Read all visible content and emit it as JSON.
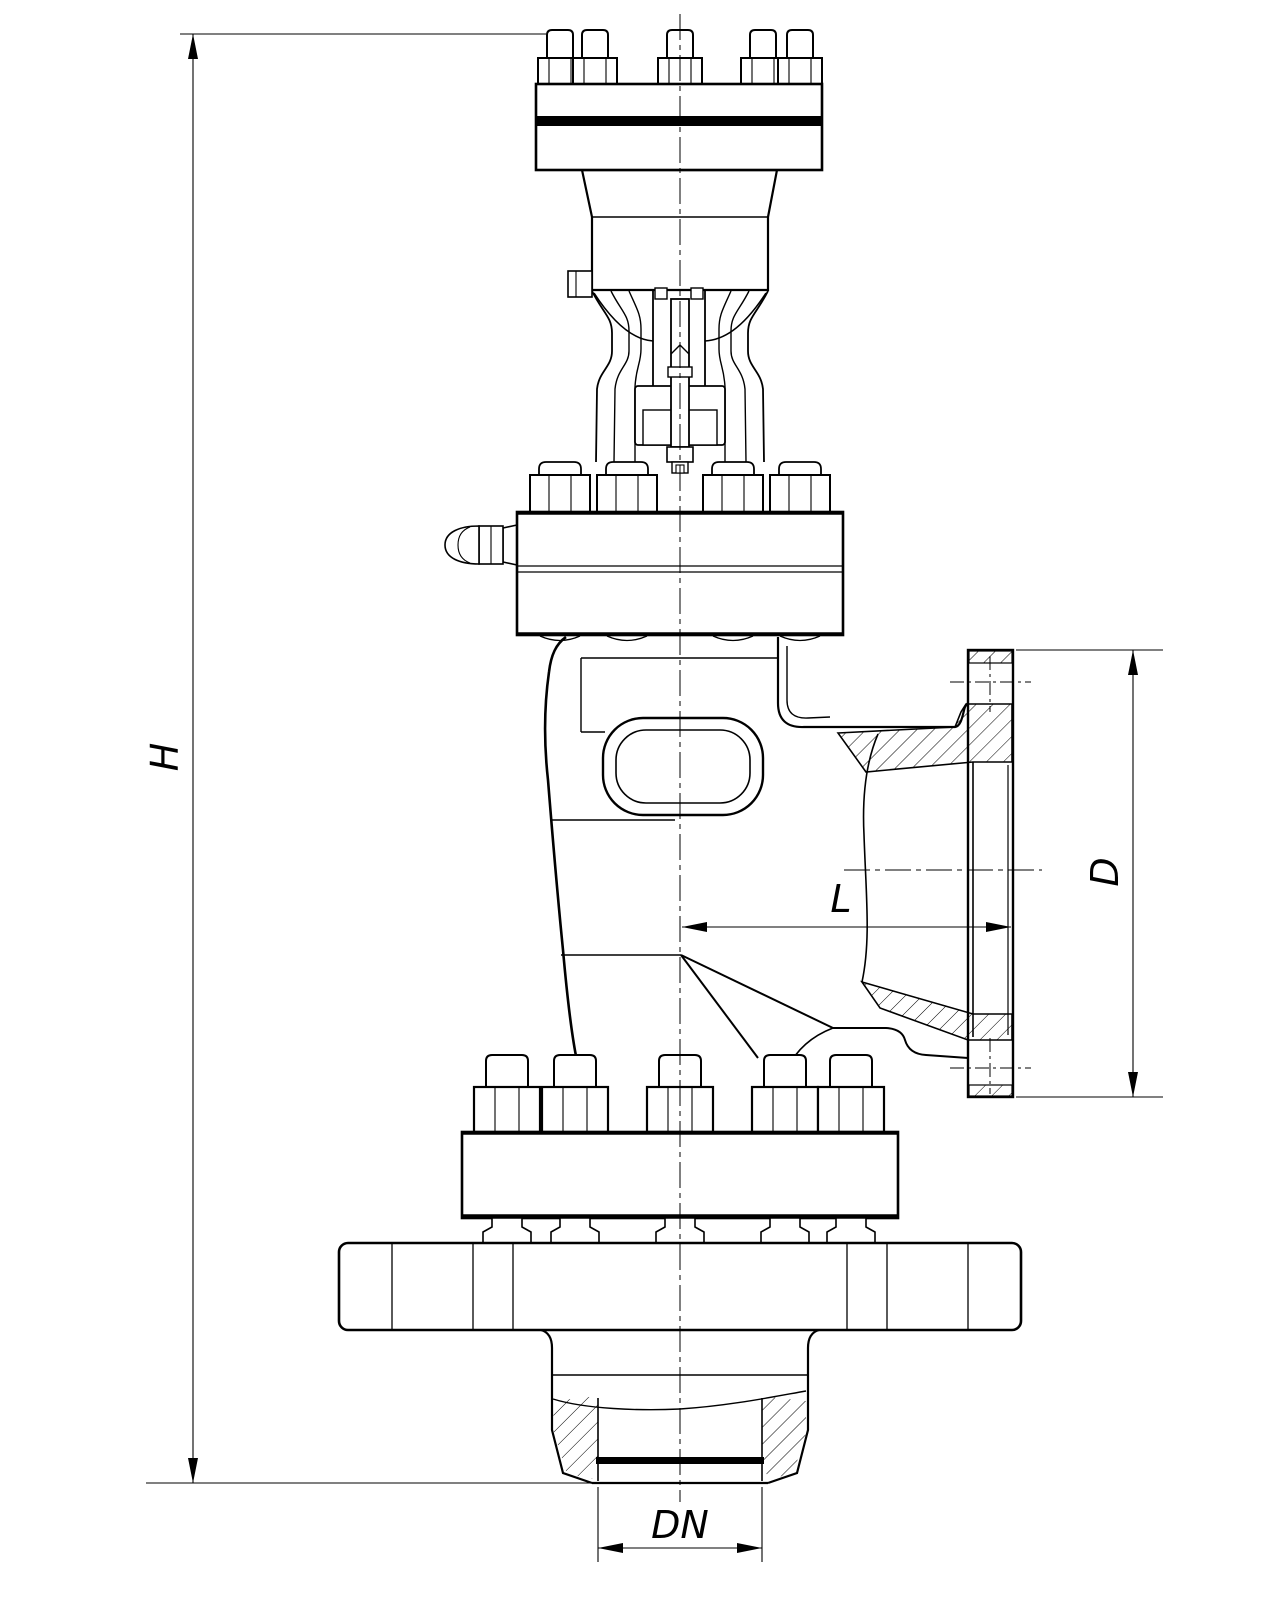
{
  "drawing": {
    "labels": {
      "height": "H",
      "flange_diameter": "D",
      "center_to_face_length": "L",
      "nominal_diameter": "DN"
    },
    "colors": {
      "line": "#000000",
      "background": "#ffffff"
    }
  }
}
